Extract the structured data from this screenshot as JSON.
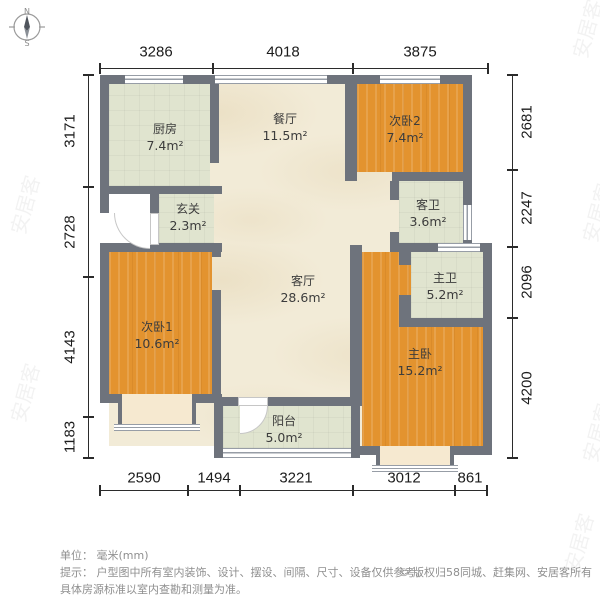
{
  "compass": {
    "north": "N",
    "south": "S"
  },
  "watermark": "安居客",
  "dimensions": {
    "top": [
      "3286",
      "4018",
      "3875"
    ],
    "bottom": [
      "2590",
      "1494",
      "3221",
      "3012",
      "861"
    ],
    "left": [
      "3171",
      "2728",
      "4143",
      "1183"
    ],
    "right": [
      "2681",
      "2247",
      "2096",
      "4200"
    ]
  },
  "rooms": {
    "kitchen": {
      "name": "厨房",
      "area": "7.4m²"
    },
    "dining": {
      "name": "餐厅",
      "area": "11.5m²"
    },
    "bedroom2": {
      "name": "次卧2",
      "area": "7.4m²"
    },
    "entry": {
      "name": "玄关",
      "area": "2.3m²"
    },
    "guest_bath": {
      "name": "客卫",
      "area": "3.6m²"
    },
    "living": {
      "name": "客厅",
      "area": "28.6m²"
    },
    "master_bath": {
      "name": "主卫",
      "area": "5.2m²"
    },
    "bedroom1": {
      "name": "次卧1",
      "area": "10.6m²"
    },
    "master_bedroom": {
      "name": "主卧",
      "area": "15.2m²"
    },
    "balcony": {
      "name": "阳台",
      "area": "5.0m²"
    }
  },
  "footer": {
    "unit_label": "单位：",
    "unit_value": "毫米(mm)",
    "tip_line1": "提示： 户型图中所有室内装饰、设计、摆设、间隔、尺寸、设备仅供参考。",
    "tip_line2": "具体房源标准以室内查勘和测量为准。",
    "copyright": "© 版权归58同城、赶集网、安居客所有"
  },
  "colors": {
    "wall": "#6e737c",
    "wood_floor": "#e3932f",
    "marble_floor": "#f2ebd7",
    "tile_floor": "#e0e4cf",
    "bay_window": "#f6e9d0"
  }
}
